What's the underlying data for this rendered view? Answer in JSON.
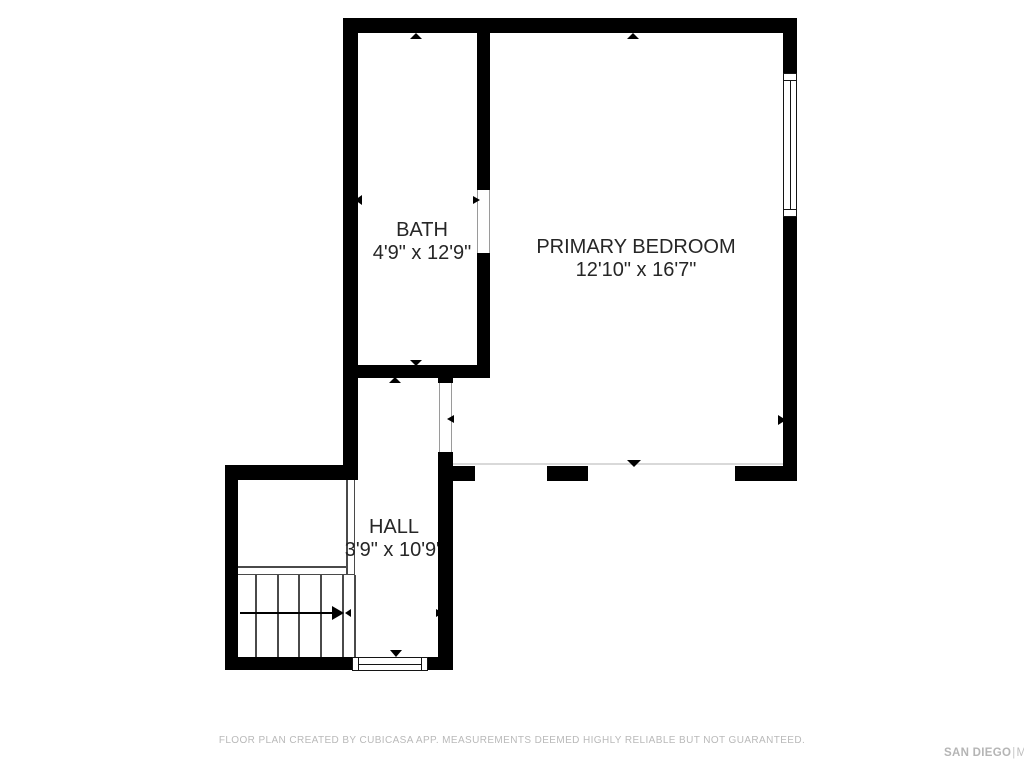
{
  "rooms": [
    {
      "id": "bath",
      "name": "BATH",
      "dimensions": "4'9\" x 12'9\""
    },
    {
      "id": "primary-bedroom",
      "name": "PRIMARY BEDROOM",
      "dimensions": "12'10\" x 16'7\""
    },
    {
      "id": "hall",
      "name": "HALL",
      "dimensions": "3'9\" x 10'9\""
    }
  ],
  "footer": {
    "disclaimer": "FLOOR PLAN CREATED BY CUBICASA APP. MEASUREMENTS DEEMED HIGHLY RELIABLE BUT NOT GUARANTEED."
  },
  "watermark": {
    "brand": "SAN DIEGO",
    "separator": "|",
    "suffix": "MLS"
  },
  "colors": {
    "wall": "#000000",
    "room_label": "#262626",
    "stair_lines": "#4a4a4a",
    "opening_line": "#d9d9d9",
    "footer_text": "#b9b9b9",
    "watermark_text": "#b5b5b5"
  }
}
